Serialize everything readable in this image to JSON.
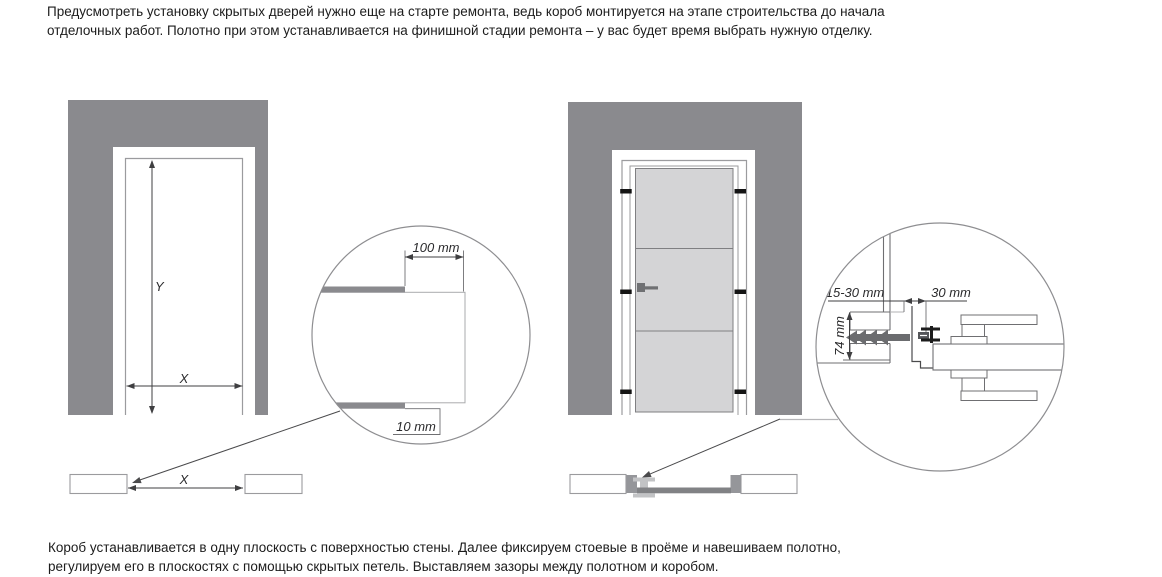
{
  "intro": {
    "line1": "Предусмотреть установку скрытых дверей нужно еще на старте ремонта, ведь короб монтируется на этапе строительства до начала",
    "line2": "отделочных работ. Полотно при этом устанавливается на финишной стадии ремонта – у вас будет время выбрать нужную отделку."
  },
  "outro": {
    "line1": "Короб устанавливается в одну плоскость с поверхностью стены. Далее фиксируем стоевые в проёме и навешиваем полотно,",
    "line2": "регулируем его в плоскостях с помощью скрытых петель. Выставляем зазоры между полотном и коробом."
  },
  "left_diagram": {
    "opening_height_label": "Y",
    "opening_width_label": "X",
    "plan_width_label": "X",
    "detail": {
      "offset_label": "100 mm",
      "finish_thickness_label": "10 mm"
    }
  },
  "right_diagram": {
    "detail": {
      "gap_label": "15-30 mm",
      "frame_depth_label": "30 mm",
      "anchor_zone_label": "74 mm"
    }
  },
  "colors": {
    "wall": "#8a8a8e",
    "door_panel": "#d4d4d6",
    "outline": "#6f6f72",
    "light_outline": "#9b9b9e",
    "dimension": "#3f3f41",
    "clip_black": "#141414",
    "anchor": "#6b6c6f",
    "plan_bar": "#818285"
  }
}
